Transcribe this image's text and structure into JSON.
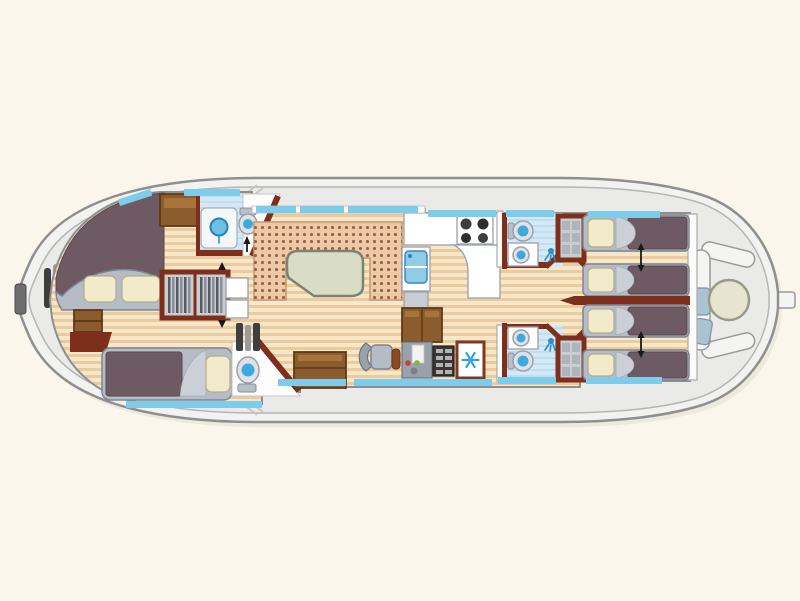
{
  "meta": {
    "width": 800,
    "height": 601,
    "kind": "canal-boat-floor-plan",
    "orientation": "bow-left"
  },
  "palette": {
    "background": "#FAF6EB",
    "hull_fill": "#F2F2F0",
    "hull_line": "#8F8F8F",
    "hull_inner_line": "#B5B5B5",
    "deck_fill": "#EAEAE8",
    "wall_red": "#7E2F1C",
    "floor_base": "#F7E7C9",
    "floor_stripe": "#EACA9F",
    "window_blue": "#7FCBEA",
    "bath_floor": "#D4E9F5",
    "bath_stripe": "#BFDEF0",
    "fixture_blue": "#3FA8DC",
    "fixture_ring": "#DFE3E8",
    "fixture_ring_line": "#9AA0A8",
    "bed_mauve": "#6D5A62",
    "bed_frame": "#B6BCC6",
    "bed_frame_line": "#7E8590",
    "bed_fold": "#CBD0D7",
    "pillow": "#F1EBCB",
    "pillow_line": "#B0AC8C",
    "cushion": "#EDC9A6",
    "cushion_line": "#C89A72",
    "cushion_dot": "#96604A",
    "table_top": "#D9DCC6",
    "table_line": "#7E8270",
    "wood_dark": "#5E3A16",
    "wood_mid": "#8A5C2E",
    "wood_light": "#A9743C",
    "counter_line": "#9AA0A8",
    "console_gray": "#9BA1AB",
    "dot_red": "#D23B2F",
    "dot_green": "#7AB648",
    "steps_dark": "#3E3E3E",
    "steps_light": "#9A9A9A",
    "snow_blue": "#29A3DC",
    "stern_table": "#E7E5CF",
    "stern_table_line": "#9A9A8A",
    "seat_blue": "#A9C3D2",
    "seat_blue_line": "#7A95A6",
    "shelf_dark": "#3E3430",
    "shelf_slat": "#AEB4BC",
    "arrow_black": "#1A1A1A"
  },
  "boat": {
    "sections": [
      {
        "name": "bow-deck",
        "features": [
          "bow-fender-bars",
          "bow-tip-cleat",
          "boarding-hatch-marks"
        ]
      },
      {
        "name": "forward-cabin",
        "features": [
          "double-bed",
          "two-pillows",
          "single-bed",
          "hanging-wardrobe",
          "shower-room",
          "wc-toilet",
          "storage-cabinet",
          "step-chest",
          "companionway-steps"
        ]
      },
      {
        "name": "saloon",
        "features": [
          "u-shaped-dinette",
          "dining-table",
          "side-cabinets",
          "entry-step-chest",
          "sliding-door-windows"
        ]
      },
      {
        "name": "galley",
        "features": [
          "four-burner-stove",
          "sink-with-drainer",
          "oven",
          "lower-wood-cabinets",
          "refrigerator-snowflake"
        ]
      },
      {
        "name": "helm",
        "features": [
          "helm-seat",
          "steering-wheel",
          "instrument-console-red-green-lights",
          "shelf-unit"
        ]
      },
      {
        "name": "aft-corridor",
        "features": [
          "bathroom-port: toilet+washbasin+shower-head",
          "bathroom-starboard: toilet+washbasin+shower-head",
          "shelved-wardrobe-port",
          "shelved-wardrobe-starboard"
        ]
      },
      {
        "name": "aft-cabins",
        "features": [
          "single-bed-1",
          "single-bed-2",
          "single-bed-3",
          "single-bed-4",
          "slide-together-arrows",
          "red-dividing-bulkhead"
        ]
      },
      {
        "name": "stern-deck",
        "features": [
          "c-shaped-bench",
          "round-cockpit-table",
          "two-seat-cushions",
          "tiller-notch"
        ]
      }
    ],
    "window_color_note": "light blue strips along cabin walls are windows"
  }
}
